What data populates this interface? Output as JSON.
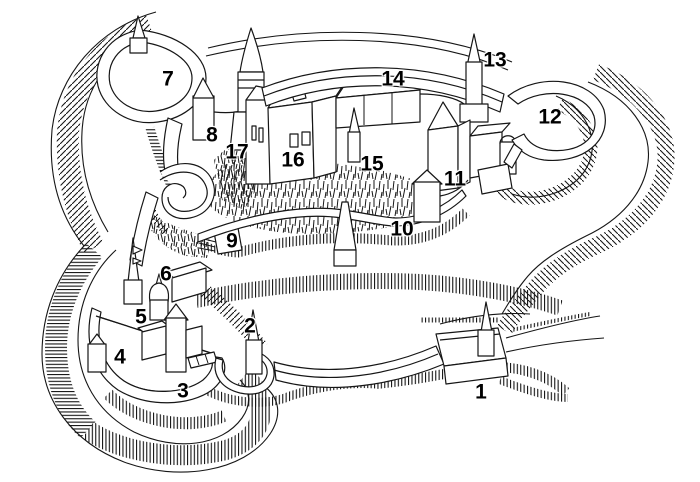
{
  "canvas": {
    "width": 700,
    "height": 482,
    "colors": {
      "ink": "#111111",
      "paper": "#ffffff"
    }
  },
  "diagram": {
    "labels": [
      {
        "id": "1",
        "text": "1",
        "x": 481,
        "y": 392
      },
      {
        "id": "2",
        "text": "2",
        "x": 250,
        "y": 326
      },
      {
        "id": "3",
        "text": "3",
        "x": 183,
        "y": 391
      },
      {
        "id": "4",
        "text": "4",
        "x": 120,
        "y": 357
      },
      {
        "id": "5",
        "text": "5",
        "x": 141,
        "y": 317
      },
      {
        "id": "6",
        "text": "6",
        "x": 166,
        "y": 274
      },
      {
        "id": "7",
        "text": "7",
        "x": 168,
        "y": 79
      },
      {
        "id": "8",
        "text": "8",
        "x": 212,
        "y": 135
      },
      {
        "id": "9",
        "text": "9",
        "x": 232,
        "y": 241
      },
      {
        "id": "10",
        "text": "10",
        "x": 402,
        "y": 229
      },
      {
        "id": "11",
        "text": "11",
        "x": 455,
        "y": 179
      },
      {
        "id": "12",
        "text": "12",
        "x": 550,
        "y": 117
      },
      {
        "id": "13",
        "text": "13",
        "x": 495,
        "y": 60
      },
      {
        "id": "14",
        "text": "14",
        "x": 393,
        "y": 79
      },
      {
        "id": "15",
        "text": "15",
        "x": 372,
        "y": 164
      },
      {
        "id": "16",
        "text": "16",
        "x": 293,
        "y": 160
      },
      {
        "id": "17",
        "text": "17",
        "x": 237,
        "y": 152
      }
    ]
  }
}
